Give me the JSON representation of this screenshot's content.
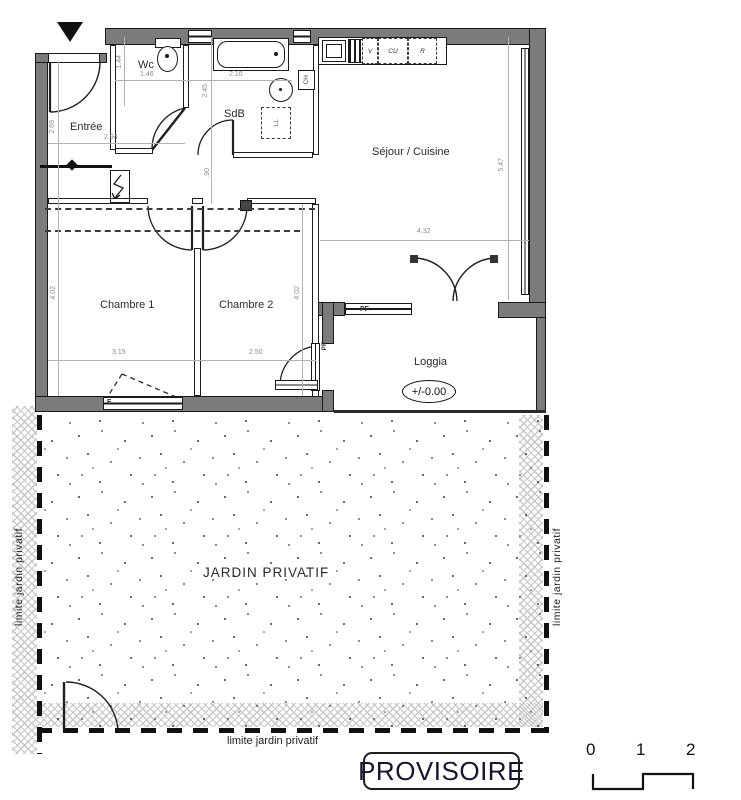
{
  "rooms": {
    "entree": "Entrée",
    "wc": "Wc",
    "sdb": "SdB",
    "sejour": "Séjour / Cuisine",
    "chambre1": "Chambre 1",
    "chambre2": "Chambre 2",
    "loggia": "Loggia",
    "jardin": "JARDIN PRIVATIF"
  },
  "level_marker": "+/-0.00",
  "annotations": {
    "pf_loggia": "PF",
    "pf_chambre2": "PF",
    "window_f": "F",
    "kitchen_v": "V",
    "kitchen_cu": "CU",
    "kitchen_r": "R",
    "water_heater": "CH",
    "washer": "LL"
  },
  "boundaries": {
    "left": "limite jardin privatif",
    "right": "limite jardin privatif",
    "bottom": "limite jardin privatif"
  },
  "dimensions": {
    "entree_w": "2.94",
    "entree_h": "2.69",
    "wc_w": "1.46",
    "wc_h": "1.44",
    "sdb_w": "2.16",
    "sdb_h": "2.45",
    "hall_passage": ".90",
    "chambre1_w": "3.15",
    "chambre1_h": "4.02",
    "chambre2_w": "2.50",
    "chambre2_h": "4.02",
    "sejour_w": "4.32",
    "sejour_h": "5.47"
  },
  "stamp": "PROVISOIRE",
  "scale_bar": {
    "ticks": [
      "0",
      "1",
      "2"
    ]
  },
  "colors": {
    "wall_fill": "#7b7b7b",
    "outline": "#1a1a1a",
    "dimension_text": "#8e8e8e",
    "hatch": "#c6c6c6"
  }
}
